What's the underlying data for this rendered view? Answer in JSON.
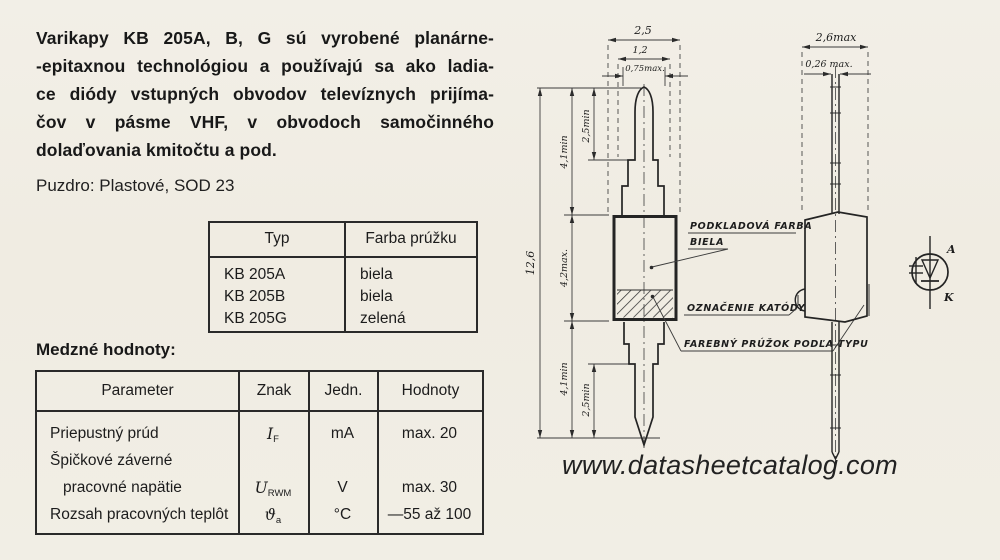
{
  "colors": {
    "paper": "#f1eee5",
    "ink": "#1e1e1e",
    "line": "#2b2b2b"
  },
  "intro": {
    "lines": [
      "Varikapy KB 205A, B, G sú vyrobené planárne-",
      "-epitaxnou technológiou a používajú sa ako ladia-",
      "ce diódy vstupných obvodov televíznych prijíma-",
      "čov v pásme VHF, v obvodoch samočinného",
      "dolaďovania kmitočtu a pod."
    ]
  },
  "package_line": "Puzdro: Plastové, SOD 23",
  "type_table": {
    "headers": [
      "Typ",
      "Farba prúžku"
    ],
    "rows": [
      [
        "KB 205A",
        "biela"
      ],
      [
        "KB 205B",
        "biela"
      ],
      [
        "KB 205G",
        "zelená"
      ]
    ]
  },
  "limits": {
    "heading": "Medzné hodnoty:",
    "headers": [
      "Parameter",
      "Znak",
      "Jedn.",
      "Hodnoty"
    ],
    "rows": [
      {
        "p": "Priepustný prúd",
        "znak": "I",
        "znak_sub": "F",
        "jedn": "mA",
        "hodnoty": "max. 20"
      },
      {
        "p1": "Špičkové záverné",
        "p2": "pracovné napätie",
        "znak": "U",
        "znak_sub": "RWM",
        "jedn": "V",
        "hodnoty": "max. 30"
      },
      {
        "p": "Rozsah pracovných teplôt",
        "znak": "ϑ",
        "znak_sub": "a",
        "jedn": "°C",
        "hodnoty": "—55 až 100"
      }
    ]
  },
  "drawing": {
    "dims": {
      "w25": "2,5",
      "w12": "1,2",
      "w075": "0,75max.",
      "h126": "12,6",
      "h41a": "4,1min",
      "h25a": "2,5min",
      "h42": "4,2max.",
      "h41b": "4,1min",
      "h25b": "2,5min",
      "w26": "2,6max",
      "w026": "0,26 max."
    },
    "labels": {
      "l1a": "PODKLADOVÁ FARBA",
      "l1b": "BIELA",
      "l2": "OZNAČENIE KATÓDY",
      "l3": "FAREBNÝ PRÚŽOK PODĽA TYPU"
    },
    "symbol": {
      "a": "A",
      "k": "K"
    }
  },
  "watermark": "www.datasheetcatalog.com"
}
